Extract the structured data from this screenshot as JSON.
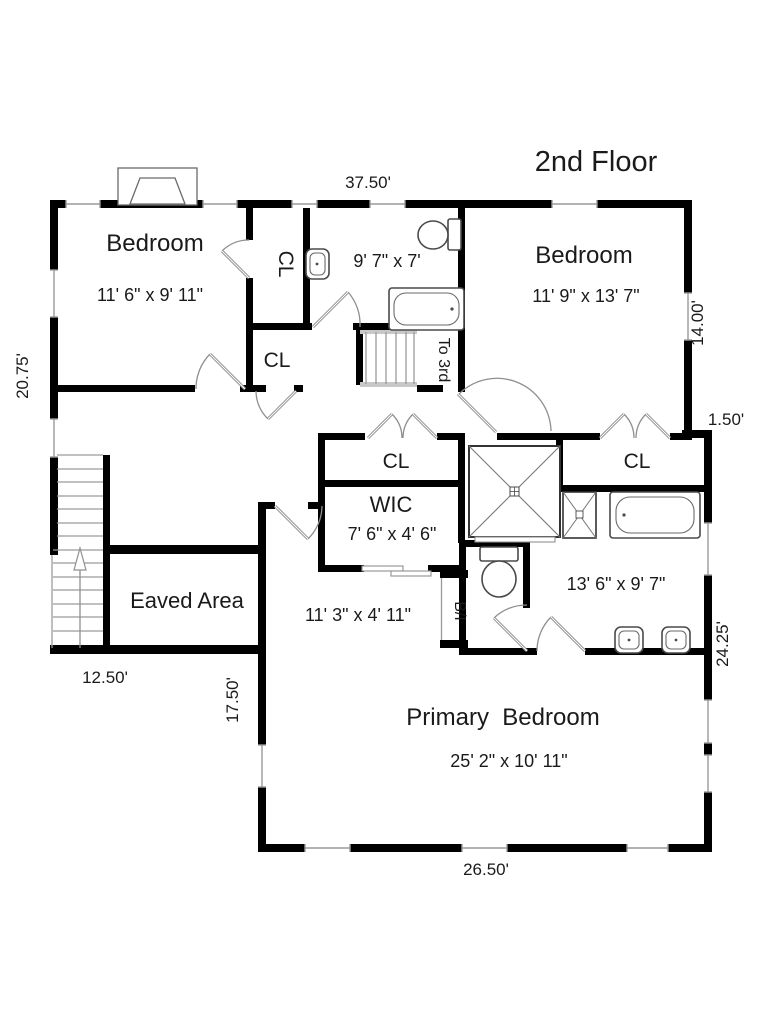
{
  "title": "2nd Floor",
  "rooms": {
    "bedroom1": {
      "name": "Bedroom",
      "dims": "11' 6\" x 9' 11\""
    },
    "bedroom2": {
      "name": "Bedroom",
      "dims": "11' 9\" x 13' 7\""
    },
    "hall_bath": {
      "dims": "9' 7\" x 7'"
    },
    "wic": {
      "name": "WIC",
      "dims": "7' 6\" x 4' 6\""
    },
    "primary_bath": {
      "dims": "13' 6\" x 9' 7\""
    },
    "primary_bedroom": {
      "name": "Primary  Bedroom",
      "dims": "25' 2\" x 10' 11\""
    },
    "suite_hall": {
      "dims": "11' 3\" x 4' 11\""
    },
    "eaved_area": {
      "name": "Eaved Area"
    }
  },
  "closets": {
    "cl_upper": "CL",
    "cl_lower": "CL",
    "cl_hall": "CL",
    "cl_bedroom2": "CL"
  },
  "annotations": {
    "stairs_up": "To 3rd",
    "built_in": "B/I"
  },
  "dimensions": {
    "top_width": "37.50'",
    "left_upper": "20.75'",
    "right_bedroom2": "14.00'",
    "right_jog": "1.50'",
    "right_lower": "24.25'",
    "stairs_width": "12.50'",
    "primary_left": "17.50'",
    "bottom_width": "26.50'"
  },
  "colors": {
    "walls": "#000000",
    "background": "#ffffff",
    "fixtures": "#4a4a4a",
    "thin_lines": "#999999"
  }
}
